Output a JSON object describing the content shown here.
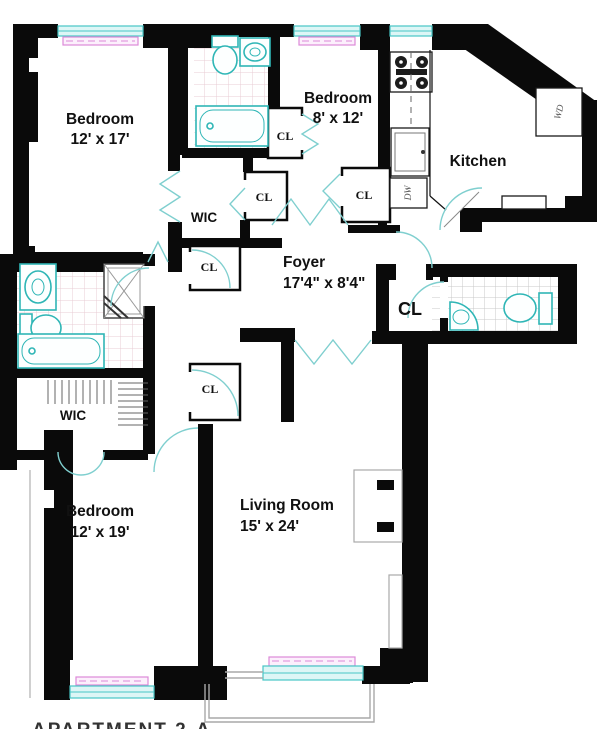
{
  "plan": {
    "rooms": {
      "bedroom1": {
        "name": "Bedroom",
        "dims": "12' x 17'"
      },
      "bedroom2": {
        "name": "Bedroom",
        "dims": "8' x 12'"
      },
      "bedroom3": {
        "name": "Bedroom",
        "dims": "12' x 19'"
      },
      "kitchen": {
        "name": "Kitchen"
      },
      "foyer": {
        "name": "Foyer",
        "dims": "17'4\" x 8'4\""
      },
      "living": {
        "name": "Living Room",
        "dims": "15' x 24'"
      },
      "wic_top": {
        "name": "WIC"
      },
      "wic_left": {
        "name": "WIC"
      }
    },
    "closets": {
      "label": "CL"
    },
    "appliances": {
      "washer_dryer": "WD",
      "dishwasher": "DW"
    },
    "footer": {
      "apartment_label": "APARTMENT 2-A"
    },
    "colors": {
      "wall": "#0a0a0a",
      "window_fill": "#ddf6f6",
      "window_stroke": "#48c6c6",
      "radiator_fill": "#fceffc",
      "radiator_stroke": "#dd8ad8",
      "fixture_stroke": "#2fb6b6",
      "door_stroke": "#7fcfcf",
      "tile_pink": "#e9ccd4",
      "tile_gray": "#c9c9c9",
      "outline_gray": "#a9a9a9",
      "text": "#111111"
    }
  }
}
